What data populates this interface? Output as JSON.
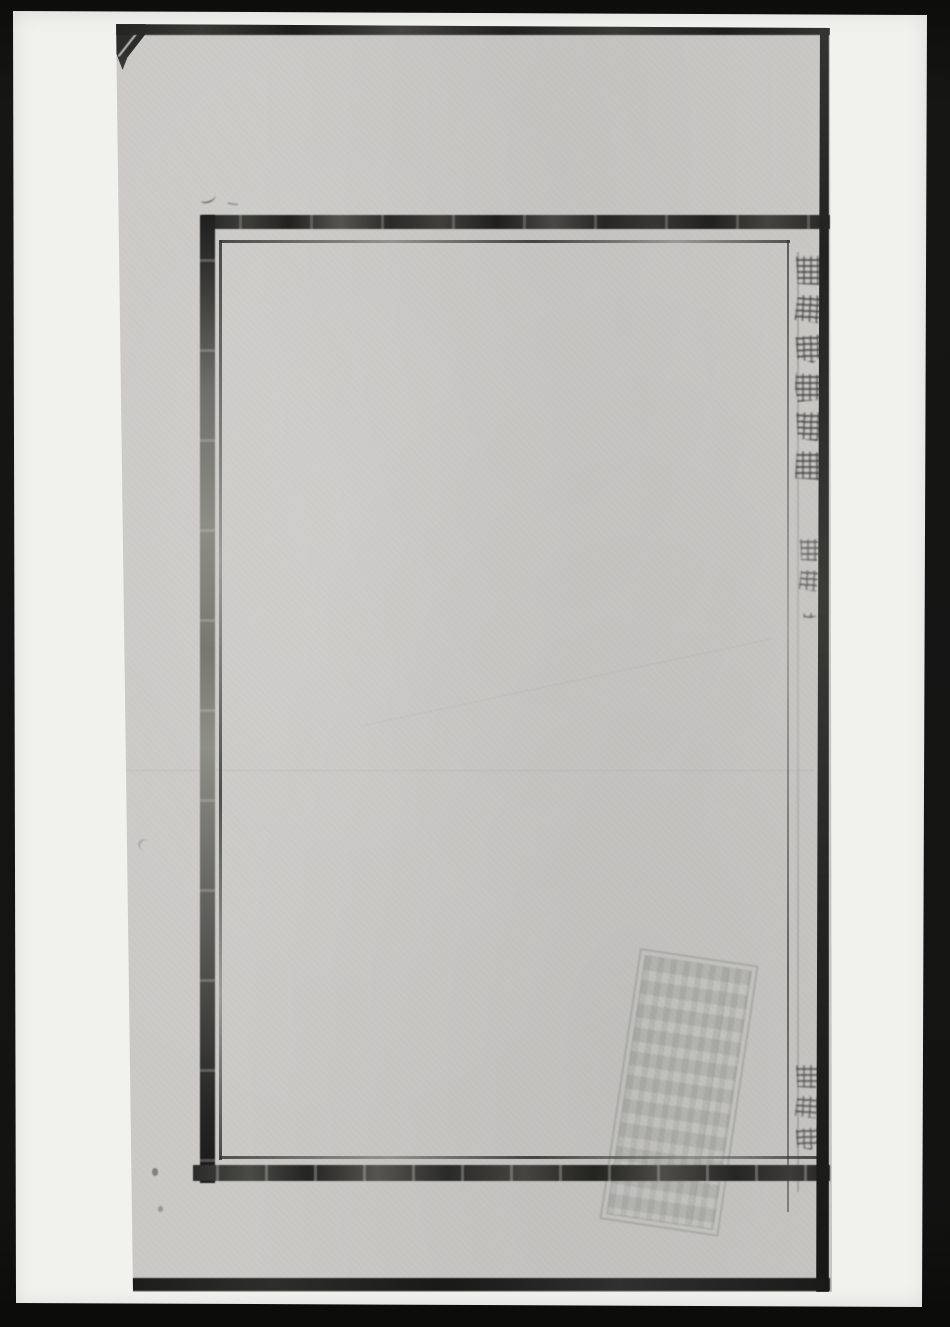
{
  "colors": {
    "scanner-bg": "#131312",
    "backing-sheet": "#f1f1ee",
    "paper": "#cac9c6",
    "border-ink": "#2b2b29",
    "text-ink": "#3c3c3a",
    "stamp-ink": "#8e938c"
  },
  "page": {
    "banxin": {
      "title_vertical": "銀谷稅氏宗譜",
      "volume_label": "卷之一",
      "hall_name": "惇慶堂",
      "fishtail_icon": "fishtail-printers-mark",
      "stamp_icon": "faint-illegible-seal-stamp"
    }
  }
}
